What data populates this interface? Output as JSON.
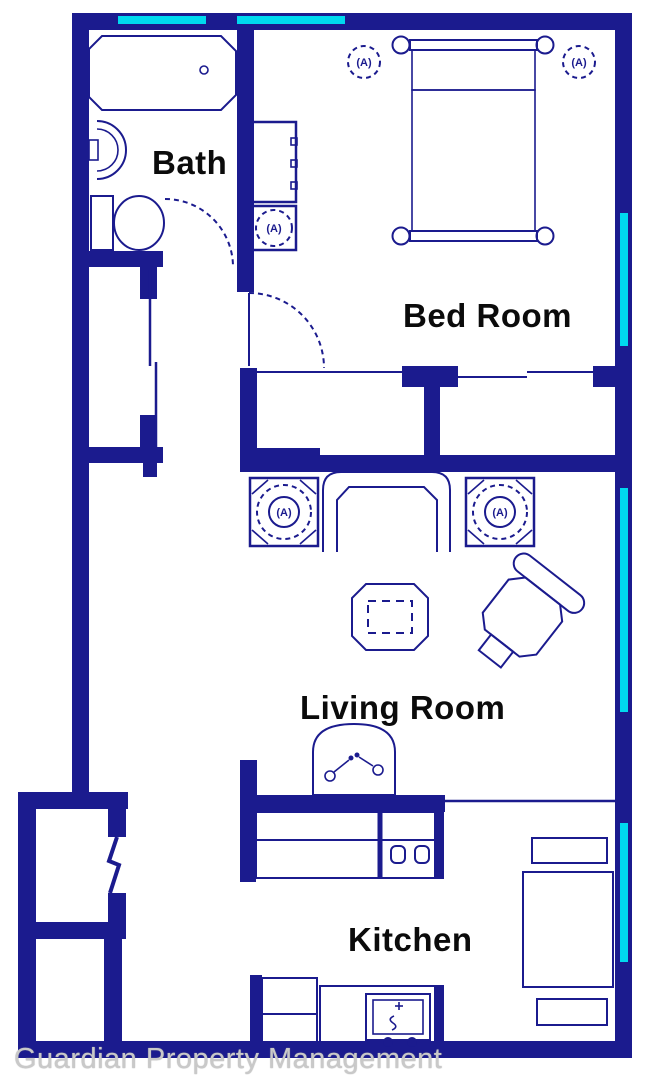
{
  "plan_title": "apartment floor plan",
  "labels": {
    "bath": "Bath",
    "bed_room": "Bed Room",
    "living_room": "Living Room",
    "kitchen": "Kitchen"
  },
  "watermark": "Guardian Property Management",
  "symbols": {
    "fixture_marker": "(A)"
  },
  "colors": {
    "wall": "#1b1b8e",
    "window": "#00d9ef",
    "fixture_line": "#1b1b8e",
    "label_text": "#0b0b0b",
    "watermark_text": "#c9c9c9",
    "background": "#ffffff"
  },
  "fixtures": [
    "bathtub",
    "bath-sink",
    "toilet",
    "hall-closet-sliding-doors",
    "bed",
    "dresser",
    "nightstand-lamp",
    "bedroom-closet",
    "end-table-lamp-left",
    "end-table-lamp-right",
    "sofa",
    "coffee-table",
    "armchair",
    "tv",
    "kitchen-counter",
    "stove-burners",
    "kitchen-sink",
    "dining-chair-top",
    "dining-table",
    "dining-chair-bottom",
    "entry-zigzag-door",
    "windows-cyan"
  ]
}
